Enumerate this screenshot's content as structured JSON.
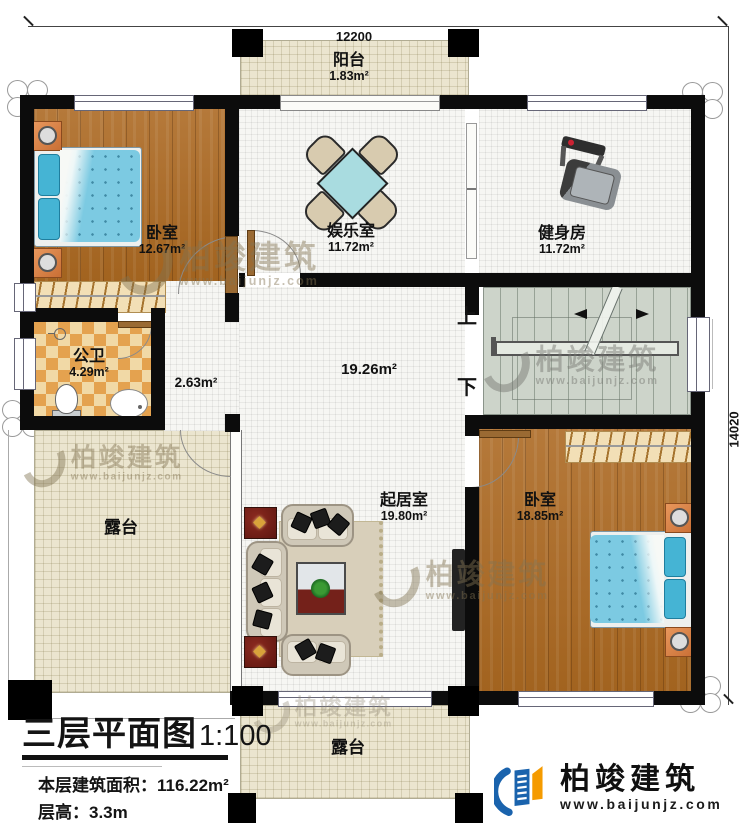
{
  "dimensions": {
    "top": "12200",
    "right": "14020"
  },
  "rooms": {
    "balcony": {
      "name": "阳台",
      "area": "1.83m²"
    },
    "bedroom1": {
      "name": "卧室",
      "area": "12.67m²"
    },
    "entertainment": {
      "name": "娱乐室",
      "area": "11.72m²"
    },
    "gym": {
      "name": "健身房",
      "area": "11.72m²"
    },
    "bathroom": {
      "name": "公卫",
      "area": "4.29m²"
    },
    "corridor": {
      "area": "2.63m²"
    },
    "hall": {
      "area": "19.26m²"
    },
    "living": {
      "name": "起居室",
      "area": "19.80m²"
    },
    "bedroom2": {
      "name": "卧室",
      "area": "18.85m²"
    },
    "terrace_left": {
      "name": "露台"
    },
    "terrace_bottom": {
      "name": "露台"
    }
  },
  "stairs": {
    "up_label": "上",
    "down_label": "下"
  },
  "title_block": {
    "title": "三层平面图",
    "scale": "1:100",
    "area_label": "本层建筑面积：",
    "area_value": "116.22m²",
    "height_label": "层高：",
    "height_value": "3.3m"
  },
  "brand": {
    "name": "柏竣建筑",
    "url": "www.baijunjz.com"
  },
  "watermark": {
    "name": "柏竣建筑",
    "url": "www.baijunjz.com"
  },
  "colors": {
    "wall": "#0c0c0c",
    "wood_floor": "#ab6d2b",
    "tile_beige": "#ebe5cf",
    "stair_fill": "#cdd4ca",
    "bed_blue": "#7ccae2",
    "bath_orange": "#e4a24f",
    "logo_blue": "#1a63ad",
    "logo_orange": "#f59b00"
  }
}
